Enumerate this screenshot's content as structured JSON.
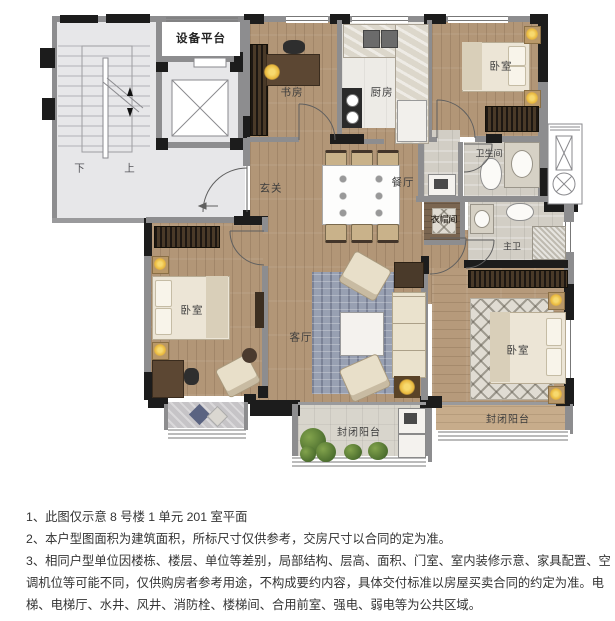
{
  "plan": {
    "equipment_platform": "设备平台",
    "stair_down": "下",
    "stair_up": "上",
    "study": "书房",
    "kitchen": "厨房",
    "bedroom_tr": "卧室",
    "bathroom": "卫生间",
    "foyer": "玄关",
    "dining": "餐厅",
    "cloakroom": "衣帽间",
    "master_bath": "主卫",
    "bedroom_left": "卧室",
    "living": "客厅",
    "bedroom_br": "卧室",
    "balcony_center": "封闭阳台",
    "balcony_right": "封闭阳台"
  },
  "notes": [
    "1、此图仅示意 8 号楼 1 单元 201 室平面",
    "2、本户型图面积为建筑面积，所标尺寸仅供参考，交房尺寸以合同的定为准。",
    "3、相同户型单位因楼栋、楼层、单位等差别，局部结构、层高、面积、门室、室内装修示意、家具配置、空调机位等可能不同，仅供购房者参考用途，不构成要约内容，具体交付标准以房屋买卖合同的约定为准。电梯、电梯厅、水井、风井、消防栓、楼梯间、合用前室、强电、弱电等为公共区域。"
  ],
  "colors": {
    "wall_dark": "#1c1c1c",
    "wall_gray": "#8d8d8f",
    "wood": "#b29677",
    "tile": "#d2cec5",
    "lamp_yellow": "#e9b83d",
    "rug_blue": "#98a0b2",
    "plant_green": "#5f7f36",
    "bed_cream": "#ece5d6"
  }
}
